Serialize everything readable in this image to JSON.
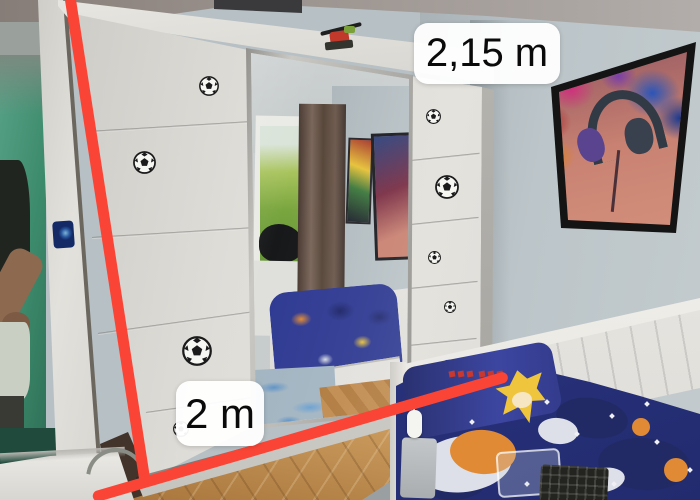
{
  "annotations": {
    "measurement_top": "2,15 m",
    "measurement_bottom": "2 m"
  },
  "colors": {
    "line": "#fa4536",
    "label_bg": "rgba(255,255,255,0.95)",
    "label_text": "#0a0a0a",
    "wall": "#b7c0c4",
    "wardrobe_white": "#dfddd8",
    "bedding_blue": "#2f3a92",
    "floor_wood": "#c0894e",
    "doorway_green": "#3c8a6c"
  },
  "wardrobe": {
    "soccer_balls": [
      {
        "x": 209,
        "y": 86,
        "d": 20
      },
      {
        "x": 144,
        "y": 162,
        "d": 23
      },
      {
        "x": 197,
        "y": 351,
        "d": 30
      },
      {
        "x": 181,
        "y": 429,
        "d": 16
      },
      {
        "x": 433,
        "y": 116,
        "d": 15
      },
      {
        "x": 447,
        "y": 187,
        "d": 24
      },
      {
        "x": 434,
        "y": 257,
        "d": 13
      },
      {
        "x": 450,
        "y": 306,
        "d": 12
      }
    ]
  },
  "bedding_patches": {
    "navy": [
      [
        556,
        398,
        72,
        40,
        8
      ],
      [
        598,
        438,
        92,
        52,
        4
      ],
      [
        424,
        468,
        62,
        32,
        -4
      ]
    ],
    "white": [
      [
        416,
        436,
        96,
        56,
        -8
      ],
      [
        583,
        468,
        42,
        24,
        -10
      ],
      [
        538,
        418,
        40,
        26,
        6
      ]
    ],
    "orange": [
      [
        450,
        430,
        66,
        44,
        4
      ],
      [
        632,
        418,
        18,
        18,
        0
      ],
      [
        664,
        458,
        24,
        24,
        0
      ]
    ],
    "stars": [
      [
        470,
        420
      ],
      [
        545,
        400
      ],
      [
        575,
        432
      ],
      [
        610,
        414
      ],
      [
        655,
        440
      ],
      [
        688,
        468
      ],
      [
        525,
        482
      ],
      [
        612,
        482
      ],
      [
        645,
        402
      ]
    ],
    "sonic_text_x": [
      449,
      458,
      467,
      479,
      488,
      497
    ],
    "sonic_text_y": 371
  }
}
